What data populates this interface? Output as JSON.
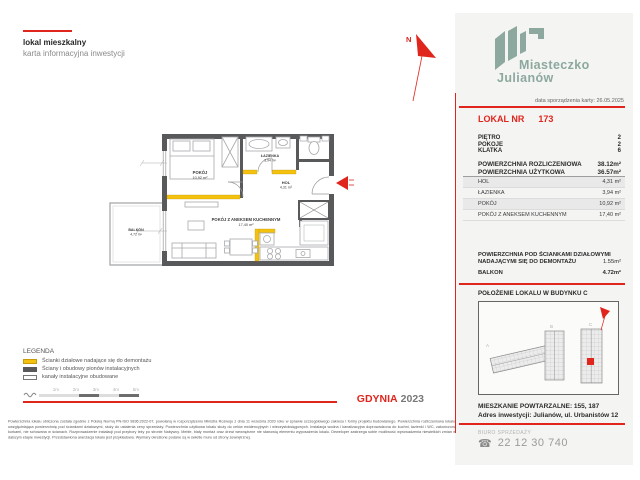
{
  "header": {
    "title": "lokal mieszkalny",
    "subtitle": "karta informacyjna inwestycji"
  },
  "brand": {
    "line1": "Miasteczko",
    "line2": "Julianów"
  },
  "panel": {
    "date_line": "data sporządzenia karty: 26.05.2025",
    "unit_label": "LOKAL NR",
    "unit_number": "173",
    "attrs": [
      {
        "label": "PIĘTRO",
        "value": "2"
      },
      {
        "label": "POKOJE",
        "value": "2"
      },
      {
        "label": "KLATKA",
        "value": "6"
      }
    ],
    "areas": [
      {
        "label": "POWIERZCHNIA ROZLICZENIOWA",
        "value": "38.12m²"
      },
      {
        "label": "POWIERZCHNIA UŻYTKOWA",
        "value": "36.57m²"
      }
    ],
    "rooms": [
      {
        "label": "HOL",
        "value": "4,31 m²"
      },
      {
        "label": "ŁAZIENKA",
        "value": "3,94 m²"
      },
      {
        "label": "POKÓJ",
        "value": "10,92 m²"
      },
      {
        "label": "POKÓJ Z ANEKSEM KUCHENNYM",
        "value": "17,40 m²"
      }
    ],
    "partition_line1": "POWIERZCHNIA POD ŚCIANKAMI DZIAŁOWYMI",
    "partition_line2": "NADAJĄCYMI SIĘ DO DEMONTAŻU",
    "partition_value": "1.55m²",
    "balkon_label": "BALKON",
    "balkon_value": "4.72m²",
    "location_title": "POŁOŻENIE LOKALU W BUDYNKU C",
    "building_labels": [
      "A",
      "B",
      "C"
    ],
    "repeat_line": "MIESZKANIE POWTARZALNE: 155, 187",
    "address_line": "Adres inwestycji: Julianów, ul. Urbanistów 12",
    "office_label": "BIURO SPRZEDAŻY",
    "phone": "22 12 30 740",
    "phone_icon": "☎"
  },
  "floorplan": {
    "north_label": "N",
    "rooms": {
      "bedroom": {
        "name": "POKÓJ",
        "area": "10,92 m²"
      },
      "bath": {
        "name": "ŁAZIENKA",
        "area": "3,94 m²"
      },
      "hall": {
        "name": "HOL",
        "area": "4,31 m²"
      },
      "living": {
        "name": "POKÓJ Z ANEKSEM KUCHENNYM",
        "area": "17,40 m²"
      },
      "balcony": {
        "name": "BALKON",
        "area": "4,72 m²"
      }
    }
  },
  "legend": {
    "title": "LEGENDA",
    "items": [
      {
        "swatch": "yellow",
        "label": "Ścianki działowe nadające się do demontażu"
      },
      {
        "swatch": "dark",
        "label": "Ściany i obudowy pionów instalacyjnych"
      },
      {
        "swatch": "outline",
        "label": "kanały instalacyjne obudowane"
      }
    ],
    "scale_ticks": [
      "1m",
      "2m",
      "3m",
      "4m",
      "5m"
    ]
  },
  "footer": {
    "city": "GDYNIA",
    "year": "2023",
    "disclaimer": "Powierzchnia lokalu obliczona została zgodnie z Polską Normą PN-ISO 9836:2022-07, powołaną w rozporządzeniu Ministra Rozwoju z dnia 11 września 2020 roku w sprawie szczegółowego zakresu i formy projektu budowlanego. Powierzchnia rozliczeniowa lokalu, uwzględniająca powierzchnię pod ściankami działowymi, służy do ustalenia ceny sprzedaży. Powierzchnia użytkowa lokalu służy do celów ewidencyjnych i wieczystoksięgowych. Instalacja wodna i kanalizacyjna doprowadzona do kuchni, łazienki i WC, zakończona korkami, nie schowana w ścianach. Rozprowadzenie instalacji pod przybory leży po stronie Nabywcy. Meble, biały montaż oraz drzwi wewnętrzne nie stanowią elementu wyposażenia lokalu. Deweloper zastrzega sobie możliwość wprowadzenia niewielkich zmian w dalszym etapie inwestycji. Przedstawiona aranżacja lokalu jest przykładowa. Wymiary określone podane są w świetle muru od strony zewnętrznej."
  },
  "colors": {
    "accent_red": "#e0251c",
    "brand_green": "#8ca89f",
    "wall_gray": "#58595b",
    "partition_yellow": "#f3c10e",
    "panel_bg": "#f4f4f3"
  }
}
